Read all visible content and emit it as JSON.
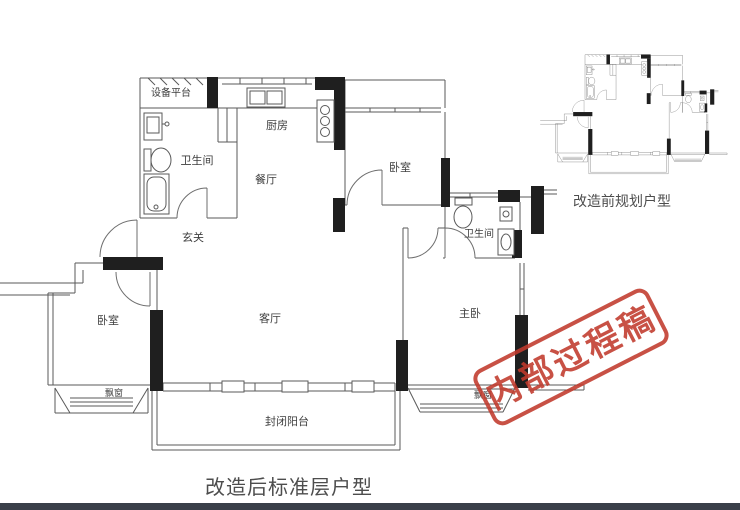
{
  "colors": {
    "stamp_red": "#c13a2c",
    "bottom_bar": "#3a3f49",
    "wall_black": "#1f1f1f",
    "line_gray": "#5a5a5a",
    "label_gray": "#3e3e3e",
    "caption_gray": "#4d4d4d"
  },
  "main_plan": {
    "caption": "改造后标准层户型",
    "rooms": {
      "equipment_platform": "设备平台",
      "bathroom1": "卫生间",
      "kitchen": "厨房",
      "dining": "餐厅",
      "entry": "玄关",
      "living": "客厅",
      "bedroom_top": "卧室",
      "bathroom2": "卫生间",
      "master": "主卧",
      "bedroom_left": "卧室",
      "bay_left": "飘窗",
      "bay_right": "飘窗",
      "balcony": "封闭阳台"
    }
  },
  "mini_plan": {
    "caption": "改造前规划户型"
  },
  "stamp": {
    "text": "内部过程稿"
  }
}
